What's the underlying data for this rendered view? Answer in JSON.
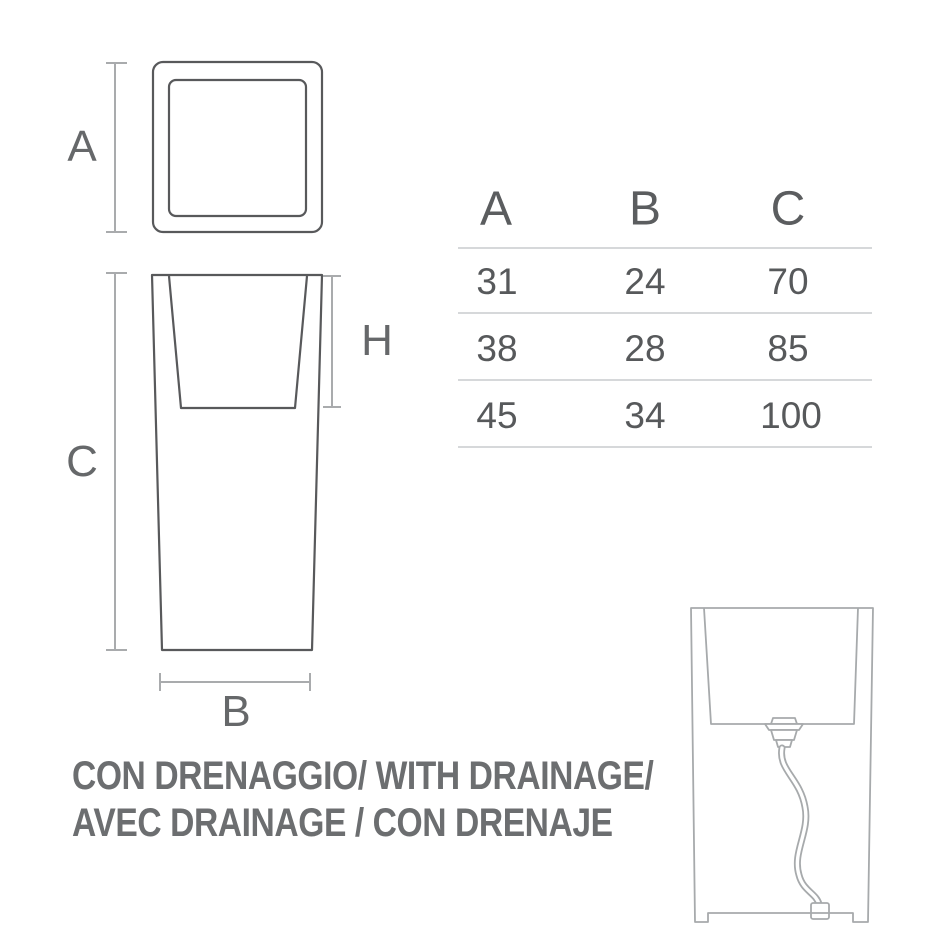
{
  "colors": {
    "outline": "#58595b",
    "dimension_line": "#a9abad",
    "label_text": "#66686a",
    "table_header_text": "#5b5d5f",
    "table_value_text": "#57595b",
    "table_rule": "#c9cbcd",
    "drainage_outline": "#a7aaac",
    "caption_text": "#6c6e70"
  },
  "dimension_labels": {
    "top_width": "A",
    "body_height": "C",
    "inner_depth": "H",
    "base_width": "B"
  },
  "size_table": {
    "headers": [
      "A",
      "B",
      "C"
    ],
    "rows": [
      [
        "31",
        "24",
        "70"
      ],
      [
        "38",
        "28",
        "85"
      ],
      [
        "45",
        "34",
        "100"
      ]
    ]
  },
  "caption": {
    "line1": "CON DRENAGGIO/ WITH DRAINAGE/",
    "line2": "AVEC DRAINAGE / CON DRENAJE"
  }
}
